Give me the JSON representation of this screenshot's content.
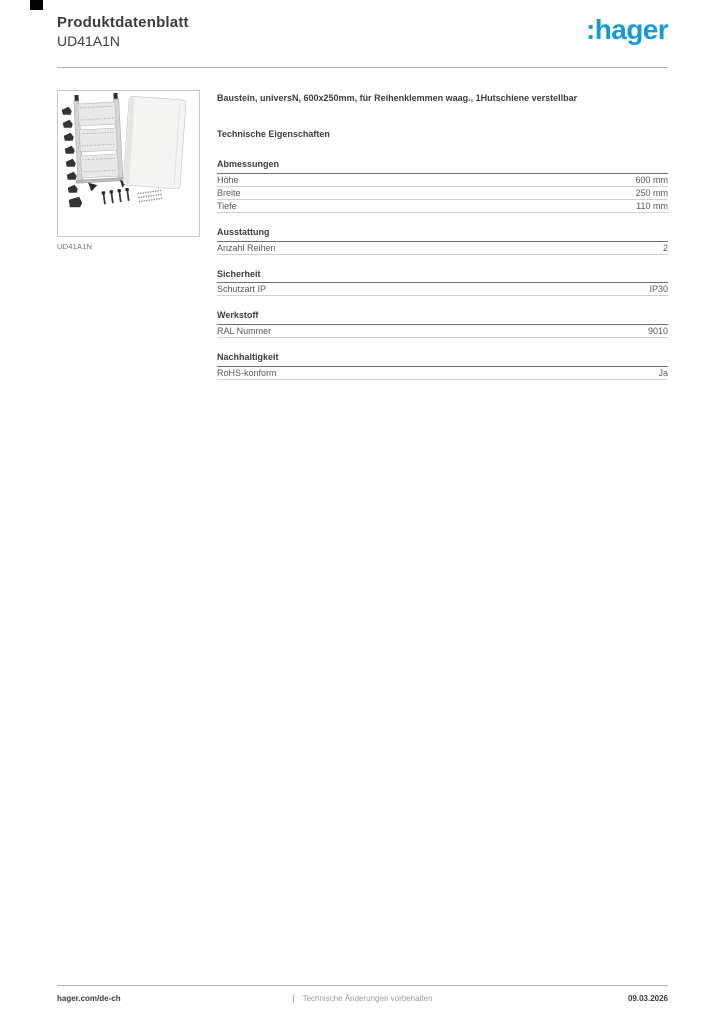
{
  "header": {
    "title": "Produktdatenblatt",
    "reference": "UD41A1N",
    "logo_text": ":hager",
    "logo_color": "#1899d6"
  },
  "product": {
    "description": "Baustein, universN, 600x250mm, für Reihenklemmen waag., 1Hutschiene verstellbar",
    "image_caption": "UD41A1N",
    "tech_properties_title": "Technische Eigenschaften"
  },
  "specs": {
    "sections": [
      {
        "title": "Abmessungen",
        "rows": [
          {
            "label": "Höhe",
            "value": "600 mm"
          },
          {
            "label": "Breite",
            "value": "250 mm"
          },
          {
            "label": "Tiefe",
            "value": "110 mm"
          }
        ]
      },
      {
        "title": "Ausstattung",
        "rows": [
          {
            "label": "Anzahl Reihen",
            "value": "2"
          }
        ]
      },
      {
        "title": "Sicherheit",
        "rows": [
          {
            "label": "Schutzart IP",
            "value": "IP30"
          }
        ]
      },
      {
        "title": "Werkstoff",
        "rows": [
          {
            "label": "RAL Nummer",
            "value": "9010"
          }
        ]
      },
      {
        "title": "Nachhaltigkeit",
        "rows": [
          {
            "label": "RoHS-konform",
            "value": "Ja"
          }
        ]
      }
    ]
  },
  "footer": {
    "website": "hager.com/de-ch",
    "disclaimer": "Technische Änderungen vorbehalten",
    "date": "09.03.2026"
  }
}
